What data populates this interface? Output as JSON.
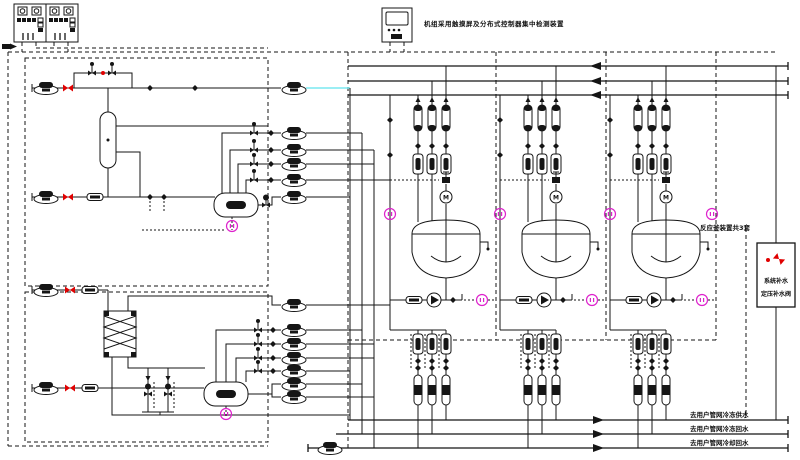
{
  "title": "制冷机组与反应釜装置流程图",
  "hmi_caption": "机组采用触摸屏及分布式控制器集中检测装置",
  "labels": {
    "reactor_area": "反应釜装置共3套",
    "makeup_box_line1": "系统补水",
    "makeup_box_line2": "定压补水阀",
    "pipe_labels": [
      "去用户管网冷冻供水",
      "去用户管网冷冻回水",
      "去用户管网冷却回水"
    ]
  },
  "colors": {
    "line": "#151515",
    "red_valve": "#e00000",
    "instrument_magenta": "#dd22cc",
    "chilled_line_cyan": "#7ae8f0",
    "background": "#ffffff"
  },
  "equipment_icons": [
    "control-panel",
    "hmi-controller",
    "screw-pump",
    "circulation-pump",
    "red-shutoff-valve",
    "actuator-control-valve",
    "motor-valve",
    "control-valve-capsule",
    "flow-component",
    "separator-column",
    "plate-heat-exchanger",
    "chiller-drum-unit",
    "reactor-vessel",
    "agitator-motor",
    "instrument-tag",
    "makeup-water-valve"
  ],
  "counts": {
    "control_panels": 2,
    "reactor_trains": 3,
    "left_screw_pumps": 4,
    "middle_pump_rows_upper": 6,
    "middle_pump_rows_lower": 7
  }
}
